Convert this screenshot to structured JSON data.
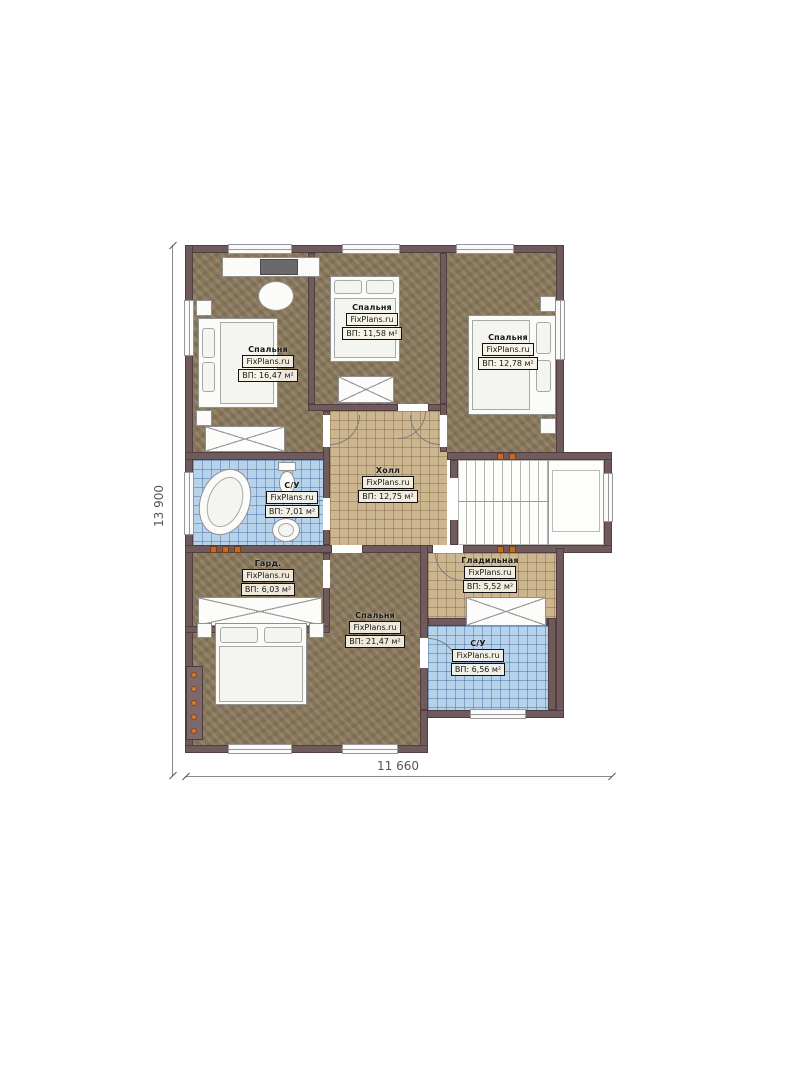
{
  "plan": {
    "title": "Floor plan, second level",
    "brand": "FixPlans.ru",
    "dimensions": {
      "bottom": "11 660",
      "left": "13 900"
    },
    "rooms": [
      {
        "key": "bedroom-top-left",
        "name": "Спальня",
        "brand": "FixPlans.ru",
        "area": "ВП: 16,47 м²"
      },
      {
        "key": "bedroom-top-middle",
        "name": "Спальня",
        "brand": "FixPlans.ru",
        "area": "ВП: 11,58 м²"
      },
      {
        "key": "bedroom-top-right",
        "name": "Спальня",
        "brand": "FixPlans.ru",
        "area": "ВП: 12,78 м²"
      },
      {
        "key": "hall",
        "name": "Холл",
        "brand": "FixPlans.ru",
        "area": "ВП: 12,75 м²"
      },
      {
        "key": "bathroom-left",
        "name": "С/У",
        "brand": "FixPlans.ru",
        "area": "ВП: 7,01 м²"
      },
      {
        "key": "wardrobe",
        "name": "Гард.",
        "brand": "FixPlans.ru",
        "area": "ВП: 6,03 м²"
      },
      {
        "key": "ironing-room",
        "name": "Гладильная",
        "brand": "FixPlans.ru",
        "area": "ВП: 5,52 м²"
      },
      {
        "key": "bedroom-bottom",
        "name": "Спальня",
        "brand": "FixPlans.ru",
        "area": "ВП: 21,47 м²"
      },
      {
        "key": "bathroom-right",
        "name": "С/У",
        "brand": "FixPlans.ru",
        "area": "ВП: 6,56 м²"
      }
    ],
    "colors": {
      "wall": "#6f5a5c",
      "floor_wood": "#8a795c",
      "floor_tile_tan": "#ccb68f",
      "floor_tile_blue": "#b7d3ec",
      "accent_orange": "#c06b2e"
    }
  }
}
